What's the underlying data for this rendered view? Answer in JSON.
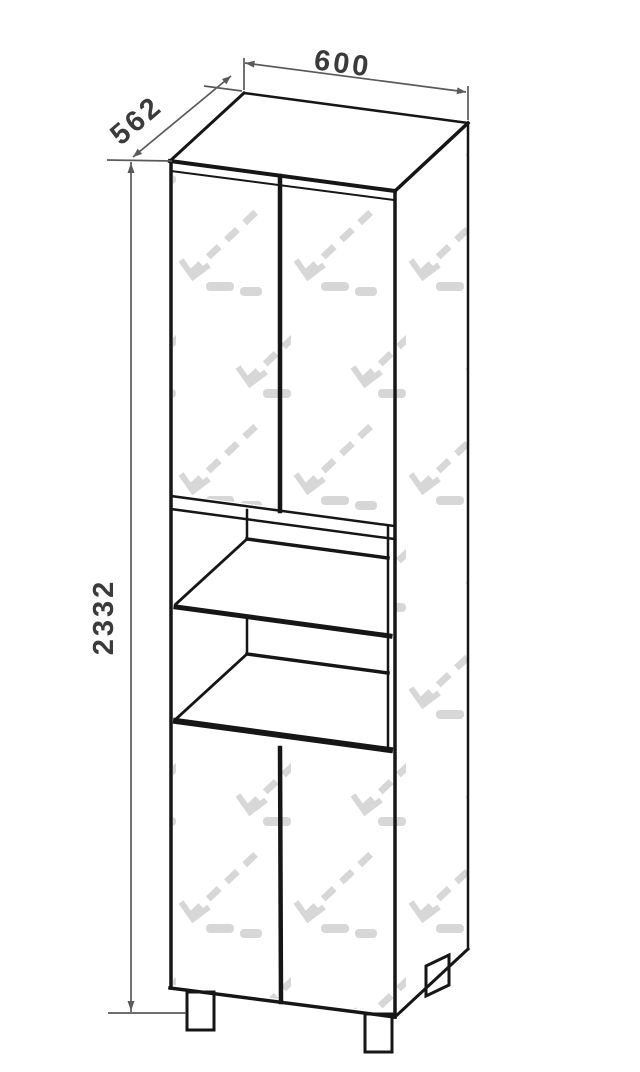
{
  "drawing": {
    "object": "tall-two-door-cabinet-with-open-shelf-niche",
    "view": "axonometric line drawing",
    "dimensions": {
      "width": "600",
      "depth": "562",
      "height": "2332"
    }
  },
  "colors": {
    "background": "#ffffff",
    "edge": "#161616",
    "dim_line": "#5a5a5a",
    "dim_text": "#3a3a3a",
    "watermark": "#bdbdbd"
  }
}
